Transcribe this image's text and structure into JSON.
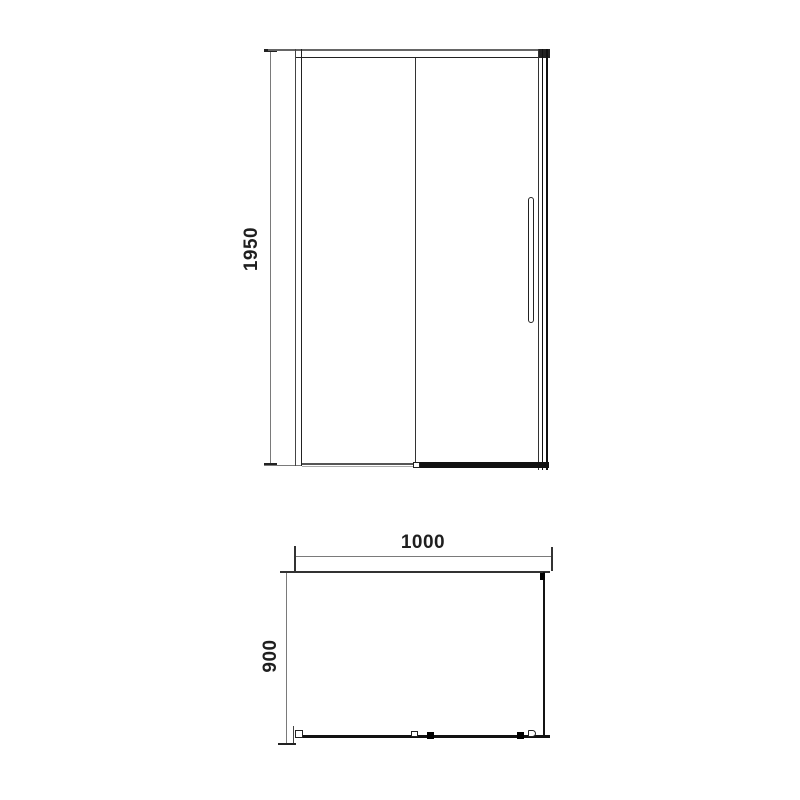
{
  "drawing": {
    "type": "shower-enclosure-technical-drawing",
    "views": {
      "front_view_name": "front elevation",
      "plan_view_name": "top plan"
    },
    "dimensions": {
      "height": "1950",
      "width": "1000",
      "depth": "900"
    },
    "colors": {
      "background": "#ffffff",
      "frame_line": "#333333",
      "thick_rail": "#111111",
      "dimension_line": "#7a7a7a",
      "label_text": "#1f1f1f"
    }
  }
}
